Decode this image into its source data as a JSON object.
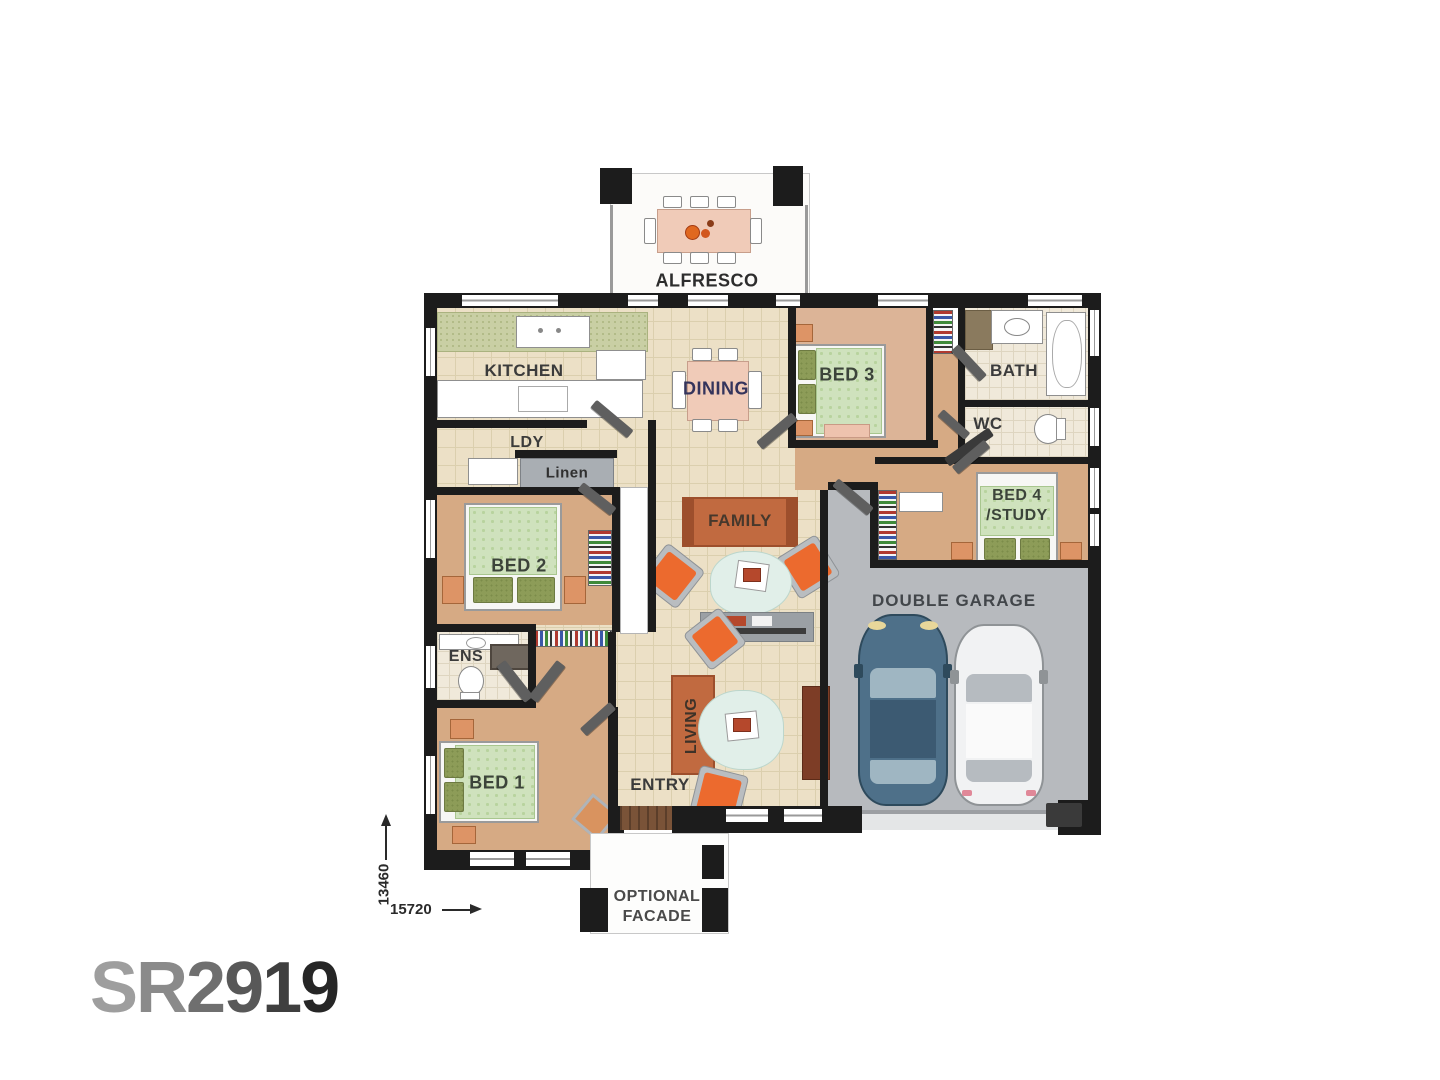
{
  "plan_id": "SR2919",
  "plan_id_colors": [
    "#9e9e9e",
    "#8a8a8a",
    "#6f6f6f",
    "#585858",
    "#3f3f3f",
    "#262626"
  ],
  "dimensions": {
    "depth": "13460",
    "width": "15720"
  },
  "rooms": {
    "alfresco": "ALFRESCO",
    "kitchen": "KITCHEN",
    "dining": "DINING",
    "bed3": "BED 3",
    "bath": "BATH",
    "wc": "WC",
    "laundry": "LDY",
    "linen": "Linen",
    "bed2": "BED 2",
    "family": "FAMILY",
    "bed4_line1": "BED 4",
    "bed4_line2": "/STUDY",
    "garage": "DOUBLE GARAGE",
    "ens": "ENS",
    "bed1": "BED 1",
    "living": "LIVING",
    "entry": "ENTRY",
    "facade_line1": "OPTIONAL",
    "facade_line2": "FACADE"
  },
  "colors": {
    "wall": "#1c1c1c",
    "tile": "#ece0c6",
    "tile_line": "#dbcfae",
    "carpet": "#d6aa84",
    "wet_tile": "#f0e9da",
    "garage_floor": "#b7babe",
    "bench": "#c9cfa4",
    "table": "#f0cbb8",
    "sofa": "#c16a40",
    "sofa_dark": "#9d4f2c",
    "armchair": "#ec6a2e",
    "chair_frame": "#b9bdc0",
    "rug": "#e1efe9",
    "bed_cover": "#cfe2bd",
    "pillow": "#8d9c58",
    "nightstand": "#dd9466",
    "linen_shelf": "#a9aeb3",
    "door": "#5f5f5f",
    "car_blue": "#4e7089",
    "car_white": "#f1f2f3",
    "mat": "#7a5338",
    "dim": "#2a2a2a"
  }
}
